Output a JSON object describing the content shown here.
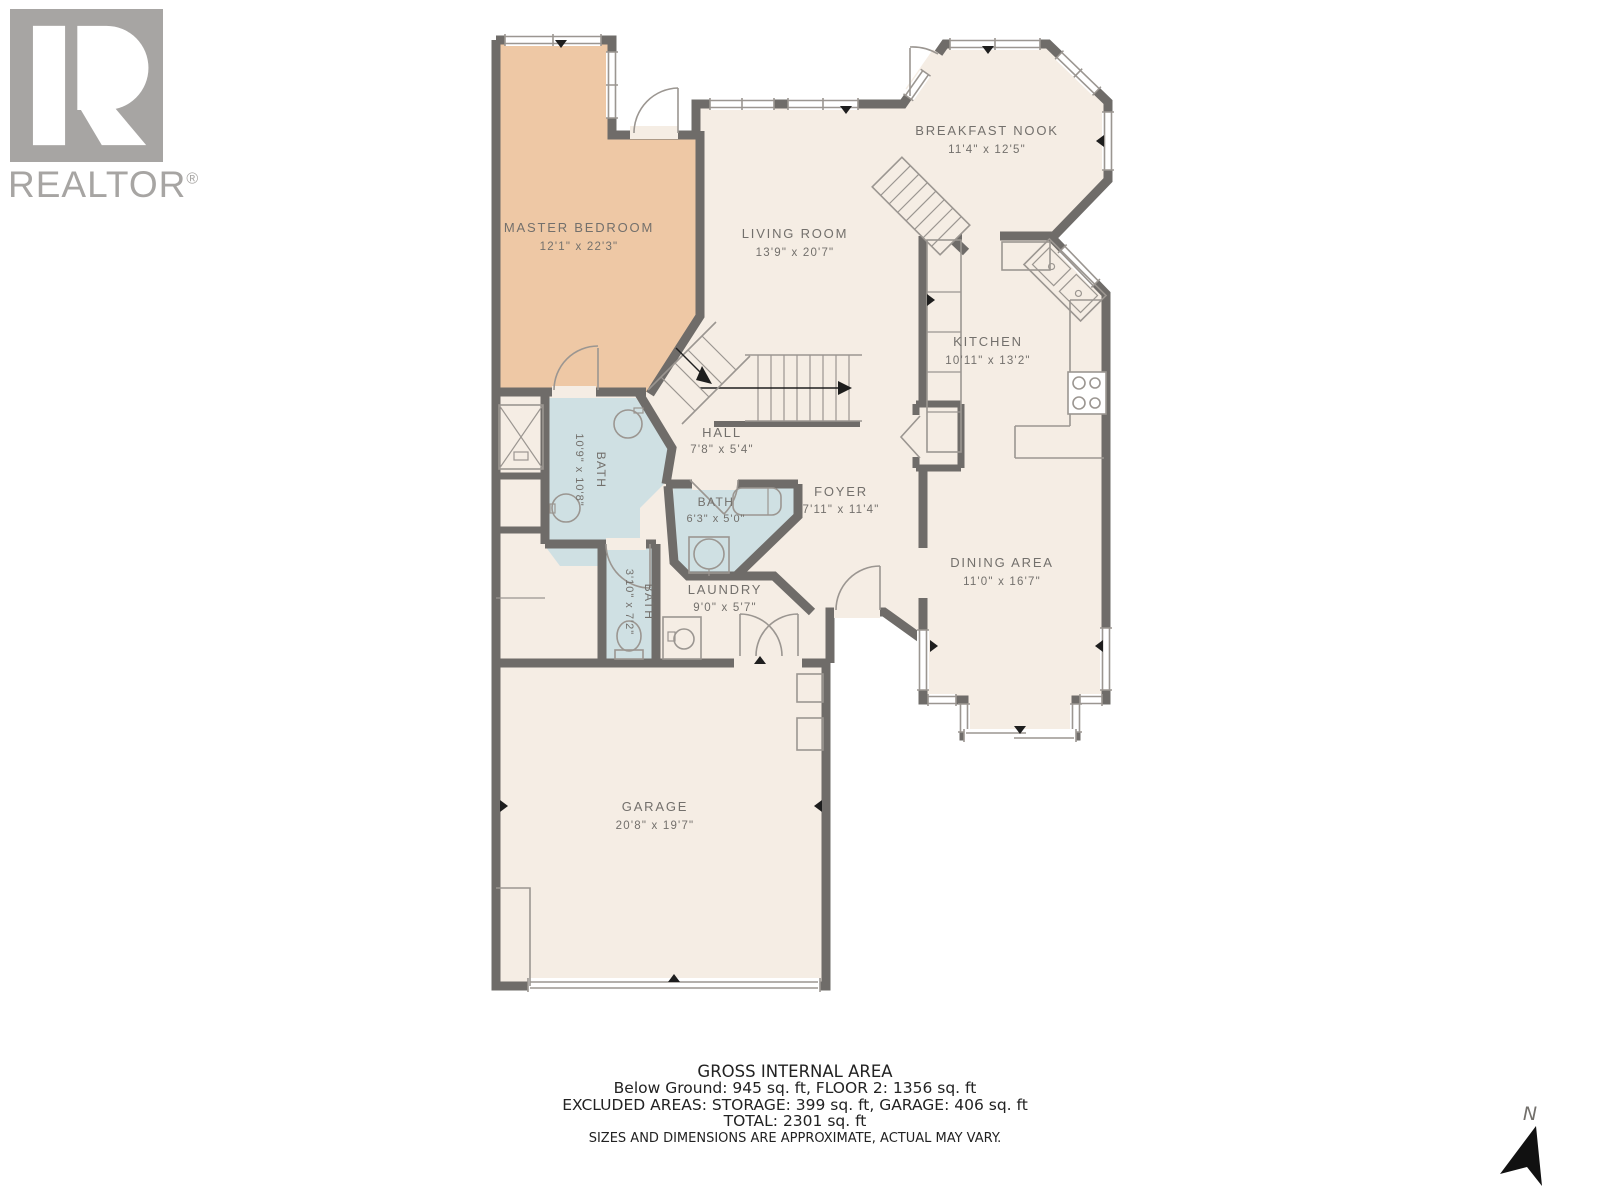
{
  "brand": {
    "name": "REALTOR",
    "registered": "®"
  },
  "compass": {
    "label": "N"
  },
  "rooms": [
    {
      "id": "master-bedroom",
      "name": "MASTER BEDROOM",
      "dims": "12'1\" x 22'3\""
    },
    {
      "id": "living-room",
      "name": "LIVING ROOM",
      "dims": "13'9\" x 20'7\""
    },
    {
      "id": "breakfast-nook",
      "name": "BREAKFAST NOOK",
      "dims": "11'4\" x 12'5\""
    },
    {
      "id": "kitchen",
      "name": "KITCHEN",
      "dims": "10'11\" x 13'2\""
    },
    {
      "id": "hall",
      "name": "HALL",
      "dims": "7'8\" x 5'4\""
    },
    {
      "id": "bath-large",
      "name": "BATH",
      "dims": "10'9\" x 10'8\""
    },
    {
      "id": "bath-middle",
      "name": "BATH",
      "dims": "6'3\" x 5'0\""
    },
    {
      "id": "bath-narrow",
      "name": "BATH",
      "dims": "3'10\" x 7'2\""
    },
    {
      "id": "foyer",
      "name": "FOYER",
      "dims": "7'11\" x 11'4\""
    },
    {
      "id": "laundry",
      "name": "LAUNDRY",
      "dims": "9'0\" x 5'7\""
    },
    {
      "id": "dining-area",
      "name": "DINING AREA",
      "dims": "11'0\" x 16'7\""
    },
    {
      "id": "garage",
      "name": "GARAGE",
      "dims": "20'8\" x 19'7\""
    }
  ],
  "footer": {
    "title": "GROSS INTERNAL AREA",
    "line1": "Below Ground: 945 sq. ft, FLOOR 2: 1356 sq. ft",
    "line2": "EXCLUDED AREAS: STORAGE: 399 sq. ft, GARAGE: 406 sq. ft",
    "line3": "TOTAL: 2301 sq. ft",
    "disclaimer": "SIZES AND DIMENSIONS ARE APPROXIMATE, ACTUAL MAY VARY."
  },
  "colors": {
    "floor": "#f5ede4",
    "master_bedroom_fill": "#eec8a5",
    "bathroom_fill": "#cfe0e3",
    "wall": "#6f6c69",
    "label_text": "#73706c",
    "logo_gray": "#a7a5a3",
    "ink": "#1e1e1e"
  }
}
